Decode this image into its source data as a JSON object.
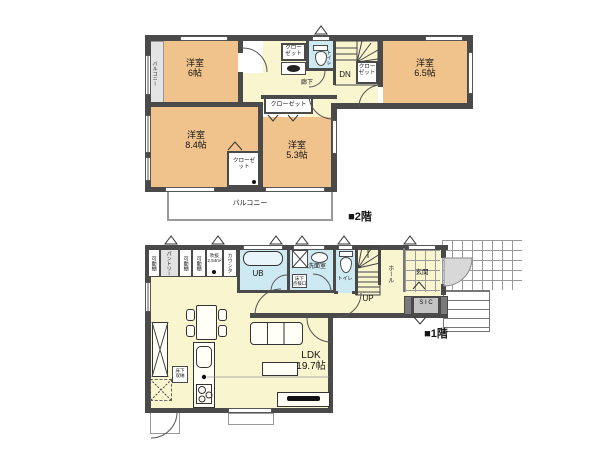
{
  "colors": {
    "wall": "#4a4a4a",
    "room_tan": "#f0c28c",
    "floor_yellow": "#f9f5cf",
    "wet_blue": "#cdeaf3",
    "balcony_gray": "#e4e4e4",
    "pantry_gray": "#e2e2e2",
    "sic_gray": "#c4c4c4"
  },
  "floor2": {
    "label": "■2階",
    "room_nw": {
      "name": "洋室",
      "size": "6帖"
    },
    "room_sw": {
      "name": "洋室",
      "size": "8.4帖"
    },
    "room_s": {
      "name": "洋室",
      "size": "5.3帖"
    },
    "room_ne": {
      "name": "洋室",
      "size": "6.5帖"
    },
    "closet": "クローゼット",
    "toilet": "トイレ",
    "hallway": "廊下",
    "stairs_dn": "DN",
    "balcony": "バルコニー"
  },
  "floor1": {
    "label": "■1階",
    "ldk": {
      "name": "LDK",
      "size": "19.7帖"
    },
    "shelf": "可動棚",
    "pantry": "パントリー",
    "void": {
      "name": "吹抜",
      "size": "2.54m²"
    },
    "counter": "カウンタ",
    "bath": "UB",
    "washroom": "洗面室",
    "floor_access": {
      "line1": "床下",
      "line2": "点検口"
    },
    "floor_storage": {
      "line1": "床下",
      "line2": "収納"
    },
    "toilet": "トイレ",
    "stairs_up": "UP",
    "hall": "ホール",
    "entrance": "玄関",
    "sic": "S I C"
  }
}
